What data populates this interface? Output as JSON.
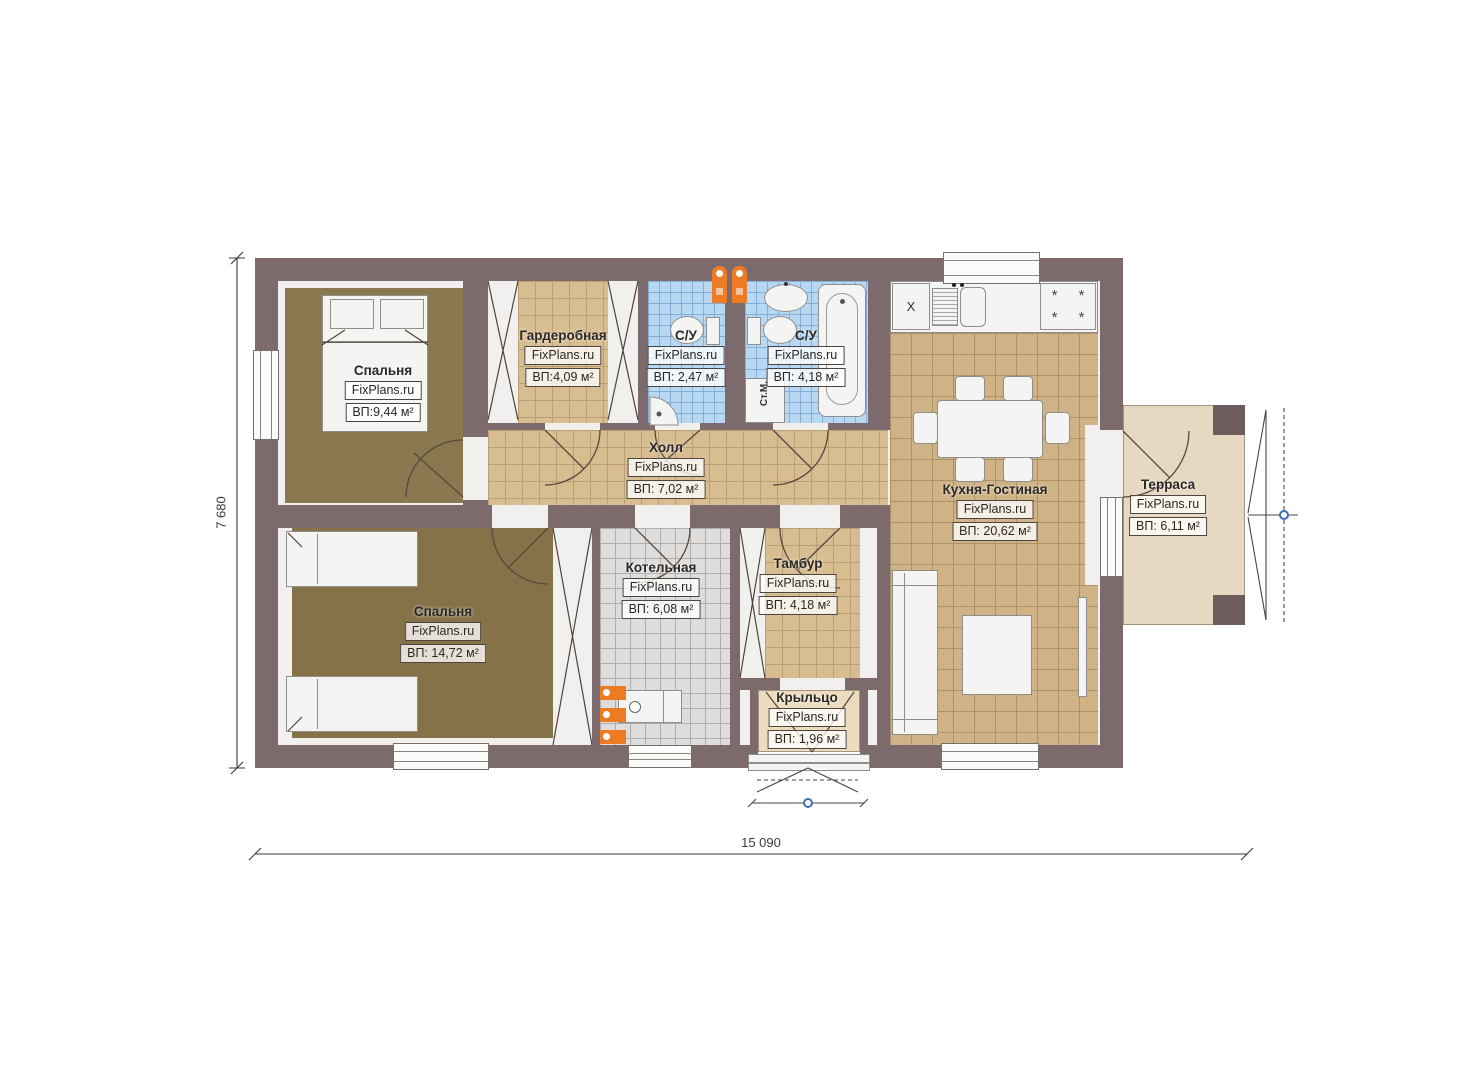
{
  "brand": "FixPlans.ru",
  "rooms": [
    {
      "name": "Спальня",
      "area": "ВП:9,44 м²"
    },
    {
      "name": "Гардеробная",
      "area": "ВП:4,09 м²"
    },
    {
      "name": "С/У",
      "area": "ВП: 2,47 м²"
    },
    {
      "name": "С/У",
      "area": "ВП: 4,18 м²"
    },
    {
      "name": "Кухня-Гостиная",
      "area": "ВП: 20,62 м²"
    },
    {
      "name": "Терраса",
      "area": "ВП: 6,11 м²"
    },
    {
      "name": "Холл",
      "area": "ВП: 7,02 м²"
    },
    {
      "name": "Спальня",
      "area": "ВП: 14,72 м²"
    },
    {
      "name": "Котельная",
      "area": "ВП: 6,08 м²"
    },
    {
      "name": "Тамбур",
      "area": "ВП: 4,18 м²"
    },
    {
      "name": "Крыльцо",
      "area": "ВП: 1,96 м²"
    }
  ],
  "dimensions": {
    "overall_width": "15 090",
    "overall_height": "7 680"
  },
  "annotations": {
    "washing_machine": "Ст.М.",
    "kitchen_unit": "X"
  },
  "colors": {
    "wall": "#7d6a6d",
    "carpet": "#8a7850",
    "tile_hall": "#d7bd90",
    "tile_bath": "#b7d8f3",
    "tile_boiler": "#dedddb",
    "tile_kitchen": "#cfb285",
    "terrace_floor": "#e6d8c1",
    "porch_floor": "#ecdcbe",
    "vent_orange": "#ed7b24",
    "marker_blue": "#3f6fb5"
  }
}
